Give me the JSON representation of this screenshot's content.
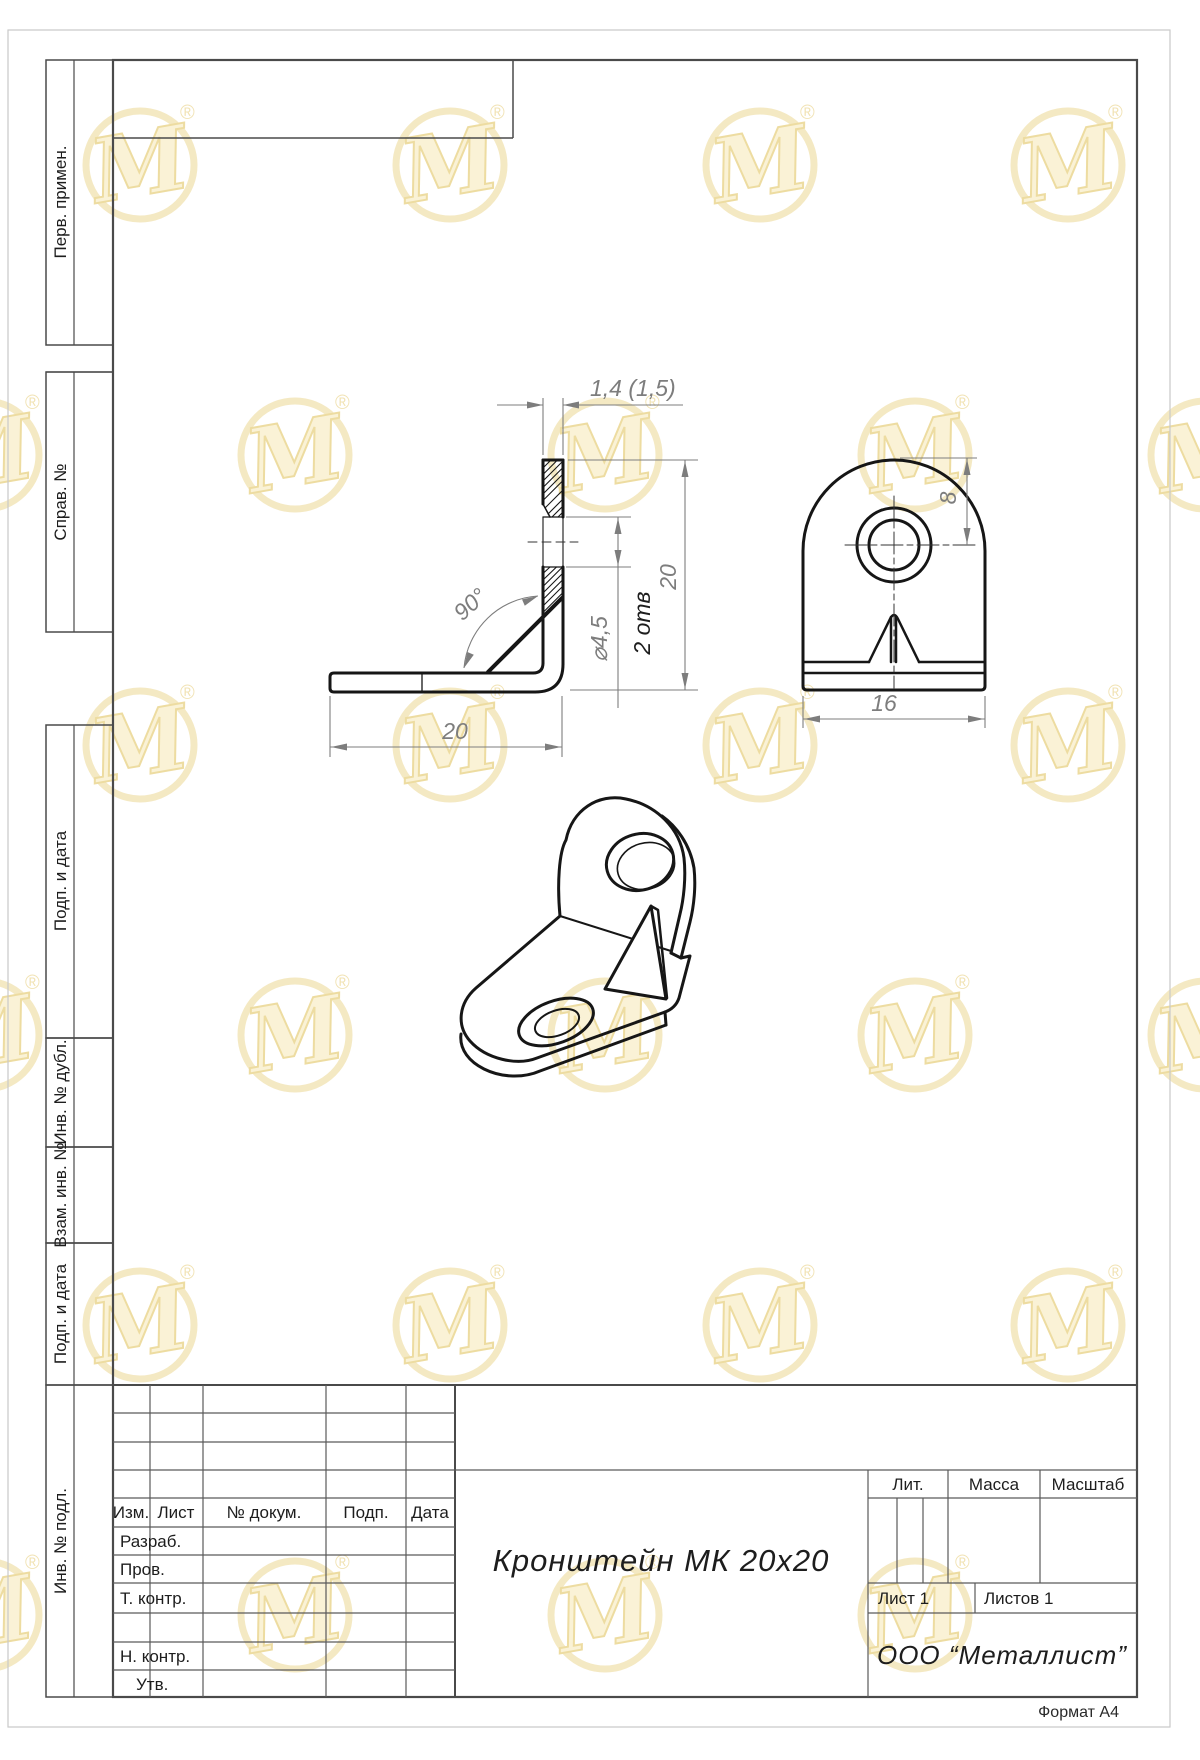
{
  "watermark": {
    "letter": "M",
    "registered": "®",
    "gold": "#DDBA45",
    "pale": "#F6E7AE"
  },
  "side_column": {
    "labels": [
      "Перв. примен.",
      "Справ. №",
      "Подп. и дата",
      "Инв. № дубл.",
      "Взам. инв. №",
      "Подп. и дата",
      "Инв. № подл."
    ]
  },
  "dims": {
    "thickness": "1,4 (1,5)",
    "angle": "90°",
    "hole_dia": "⌀4,5",
    "hole_note": "2 отв",
    "height": "20",
    "width": "20",
    "hole_offset": "8",
    "plate_width": "16"
  },
  "title_block": {
    "rev_headers": [
      "Изм.",
      "Лист",
      "№ докум.",
      "Подп.",
      "Дата"
    ],
    "roles": [
      "Разраб.",
      "Пров.",
      "Т. контр.",
      "Н. контр.",
      "Утв."
    ],
    "lit": "Лит.",
    "mass": "Масса",
    "scale": "Масштаб",
    "title": "Кронштейн МК 20х20",
    "sheet": "Лист 1",
    "sheets": "Листов 1",
    "company": "ООО “Металлист”"
  },
  "footer": {
    "format": "Формат А4"
  }
}
